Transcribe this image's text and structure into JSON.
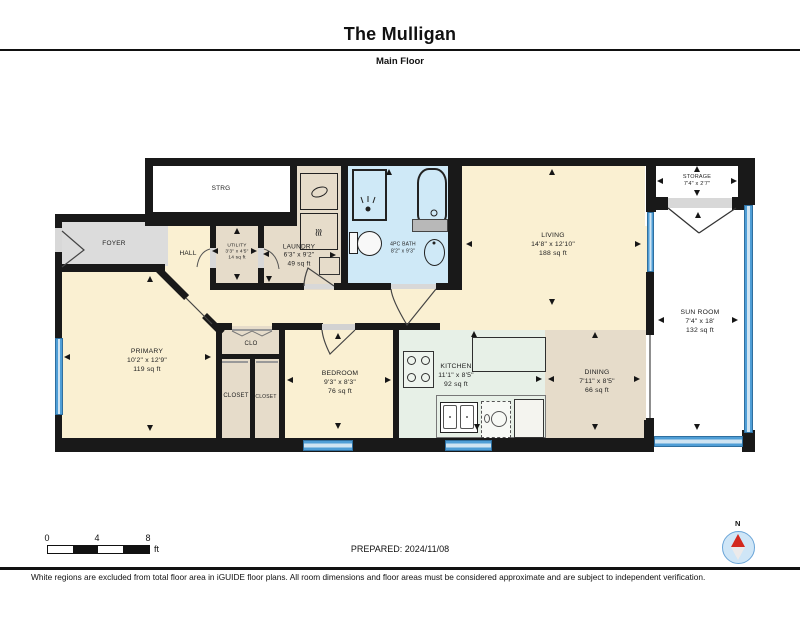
{
  "header": {
    "title": "The Mulligan",
    "subtitle": "Main Floor"
  },
  "rooms": {
    "strg": {
      "name": "STRG"
    },
    "foyer": {
      "name": "FOYER"
    },
    "hall": {
      "name": "HALL"
    },
    "utility": {
      "name": "UTILITY",
      "dims": "3'3\" x 4'5\"",
      "area": "14 sq ft"
    },
    "laundry": {
      "name": "LAUNDRY",
      "dims": "6'3\" x 9'2\"",
      "area": "49 sq ft"
    },
    "bath": {
      "name": "4PC BATH",
      "dims": "8'2\" x 9'3\""
    },
    "living": {
      "name": "LIVING",
      "dims": "14'8\" x 12'10\"",
      "area": "188 sq ft"
    },
    "storage": {
      "name": "STORAGE",
      "dims": "7'4\" x 2'7\""
    },
    "sunroom": {
      "name": "SUN ROOM",
      "dims": "7'4\" x 18'",
      "area": "132 sq ft"
    },
    "primary": {
      "name": "PRIMARY",
      "dims": "10'2\" x 12'9\"",
      "area": "119 sq ft"
    },
    "clo": {
      "name": "CLO"
    },
    "closet_left": {
      "name": "CLOSET"
    },
    "closet_right": {
      "name": "CLOSET"
    },
    "bedroom": {
      "name": "BEDROOM",
      "dims": "9'3\" x 8'3\"",
      "area": "76 sq ft"
    },
    "kitchen": {
      "name": "KITCHEN",
      "dims": "11'1\" x 8'5\"",
      "area": "92 sq ft"
    },
    "dining": {
      "name": "DINING",
      "dims": "7'11\" x 8'5\"",
      "area": "66 sq ft"
    }
  },
  "icons": {
    "dryer_heat_glyph": "≋"
  },
  "footer": {
    "prepared": "PREPARED: 2024/11/08",
    "scale_ticks": [
      "0",
      "4",
      "8"
    ],
    "scale_unit": "ft",
    "compass_label": "N",
    "disclaimer": "White regions are excluded from total floor area in iGUIDE floor plans. All room dimensions and floor areas must be considered approximate and are subject to independent verification."
  },
  "colors": {
    "wall": "#191919",
    "window_blue": "#4f9ed6",
    "bath_blue": "#cfe9f7",
    "kitchen_green": "#e7f0e7",
    "room_cream": "#faf0d2",
    "room_tan": "#e6dcca",
    "foyer_gray": "#dcdcdc",
    "compass_red": "#d3281e"
  }
}
